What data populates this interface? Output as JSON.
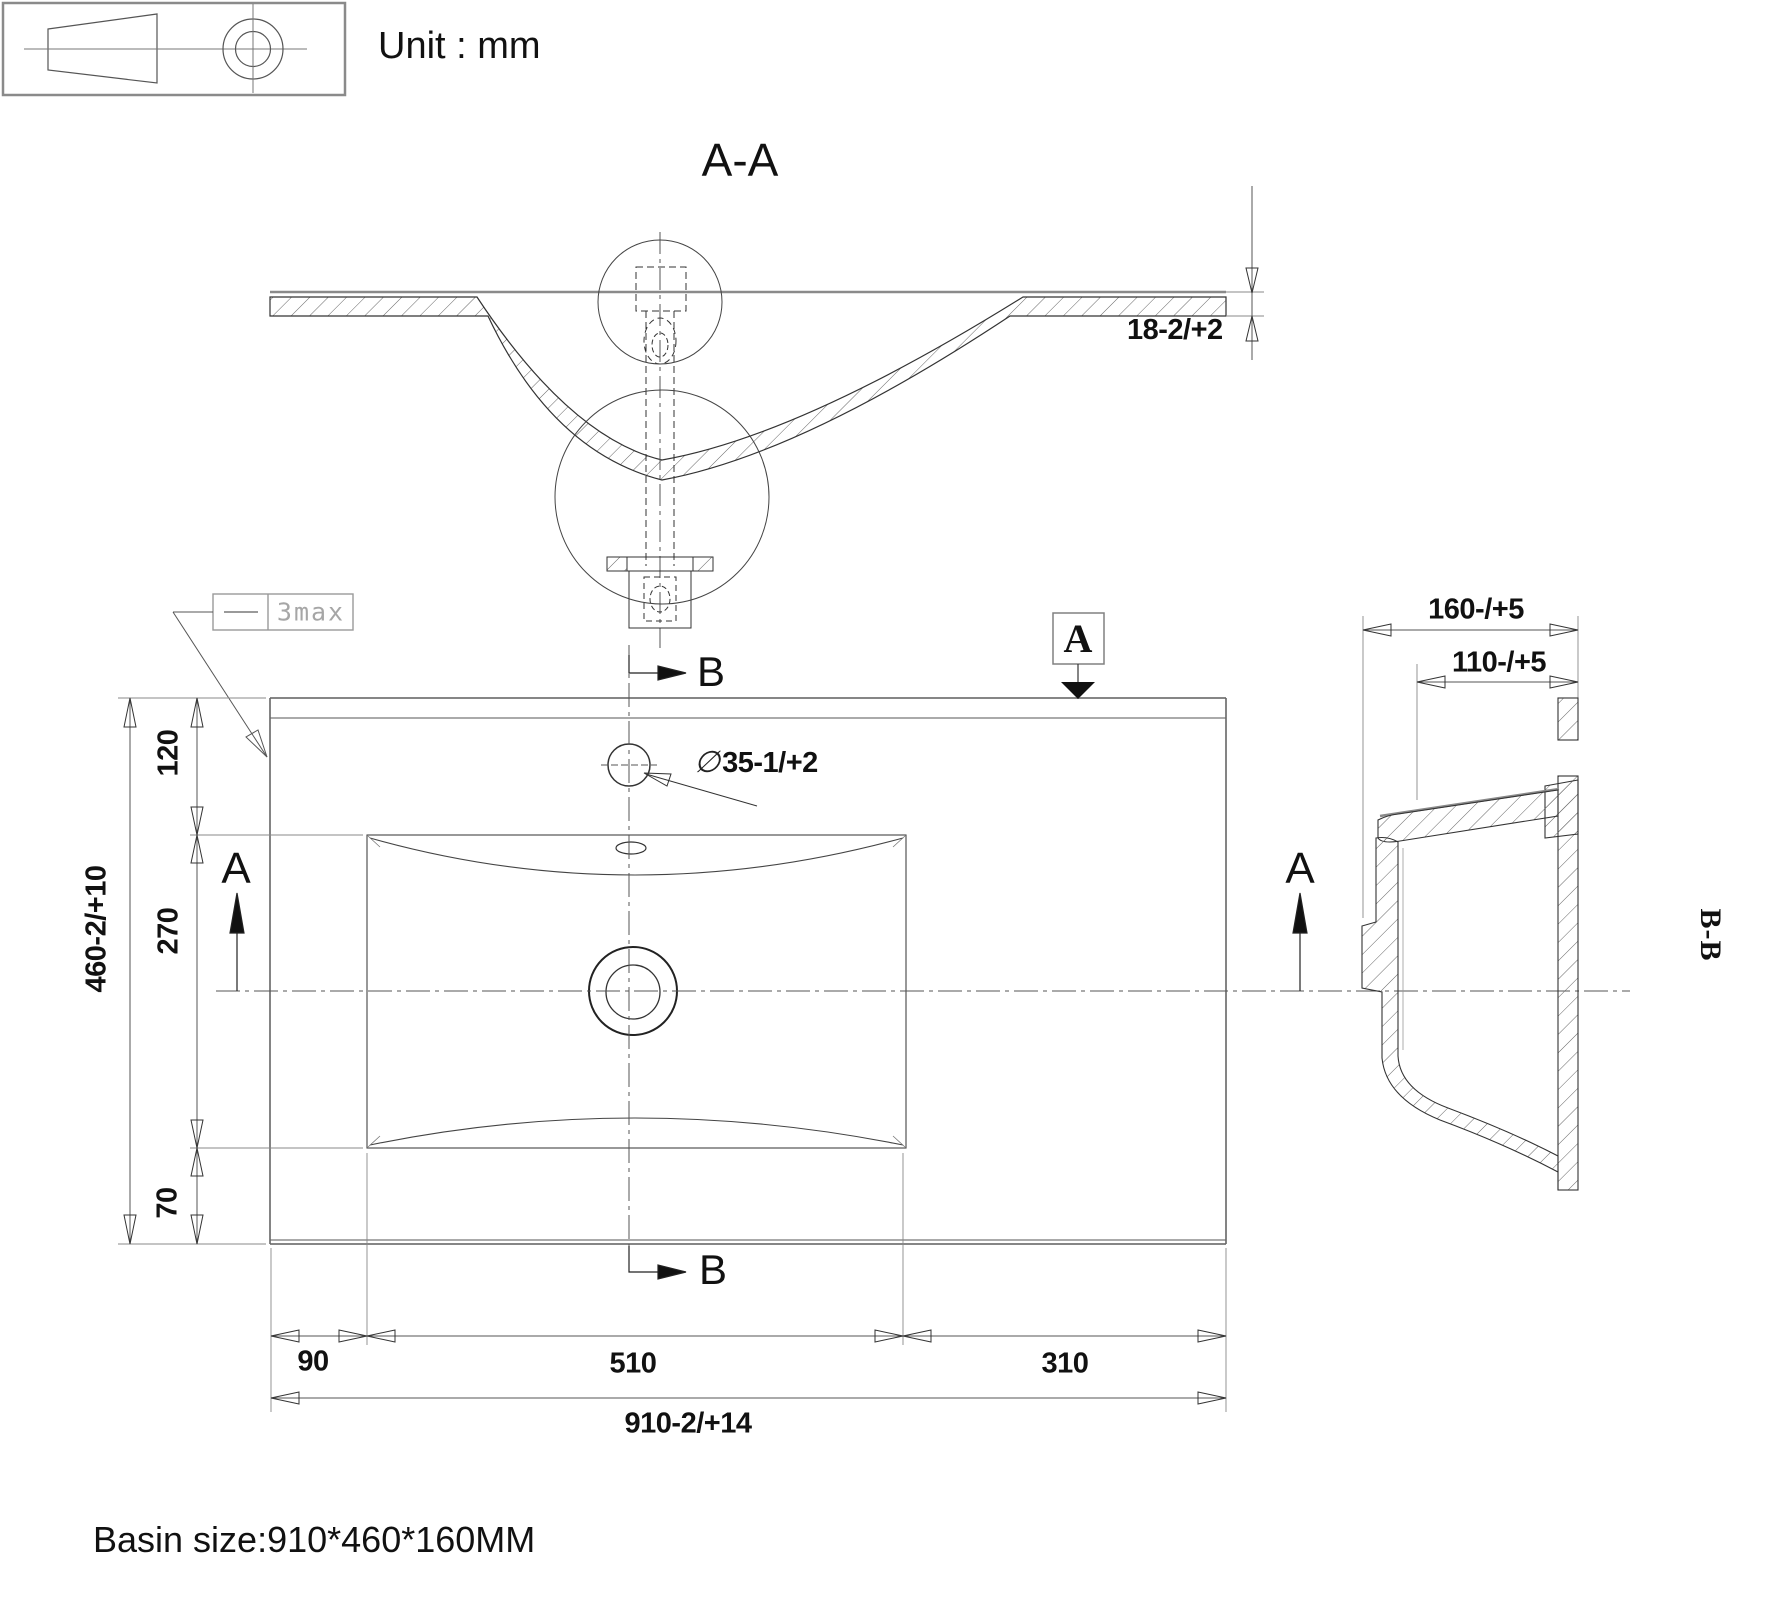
{
  "meta": {
    "unit_label": "Unit : mm",
    "basin_size_label": "Basin size:910*460*160MM"
  },
  "views": {
    "section_aa": {
      "title": "A-A",
      "deck_thickness": "18-2/+2"
    },
    "plan": {
      "flatness_tolerance": "3max",
      "faucet_hole": {
        "symbol": "∅",
        "value": "35-1/+2"
      },
      "cut_marker_a": "A",
      "cut_marker_b": "B",
      "height_segments": {
        "top": "120",
        "bowl": "270",
        "bottom": "70"
      },
      "height_overall": "460-2/+10",
      "width_segments": {
        "left": "90",
        "bowl": "510",
        "right": "310"
      },
      "width_overall": "910-2/+14"
    },
    "section_bb": {
      "title": "B-B",
      "depth_overall": "160-/+5",
      "depth_inner": "110-/+5"
    }
  }
}
